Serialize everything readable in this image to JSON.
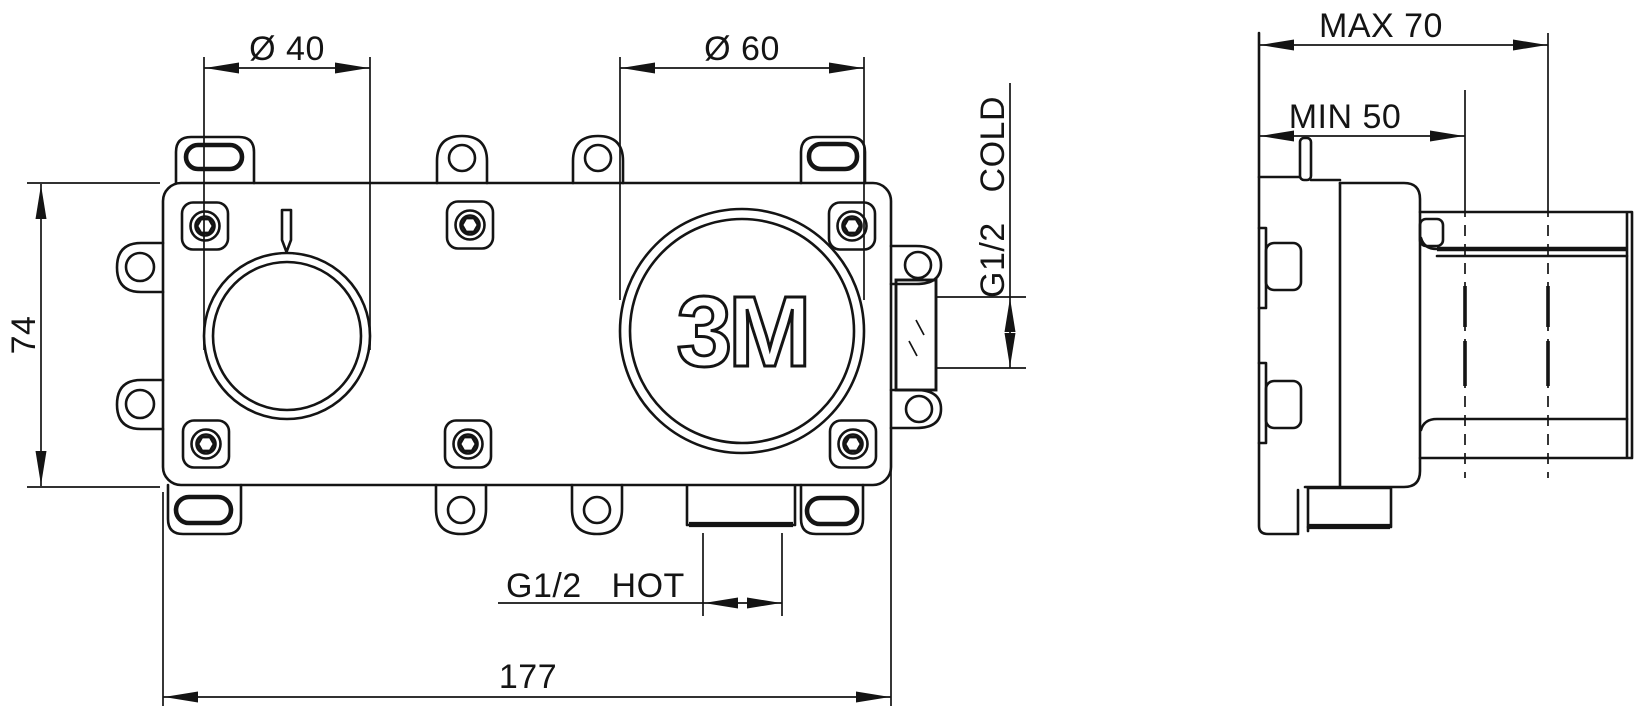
{
  "colors": {
    "background": "#ffffff",
    "line": "#141414"
  },
  "front_view": {
    "logo": "3M",
    "dims": {
      "d40": "Ø 40",
      "d60": "Ø 60",
      "height": "74",
      "width": "177",
      "hot": "G1/2   HOT",
      "cold": "G1/2   COLD"
    }
  },
  "side_view": {
    "dims": {
      "max": "MAX 70",
      "min": "MIN 50"
    }
  }
}
